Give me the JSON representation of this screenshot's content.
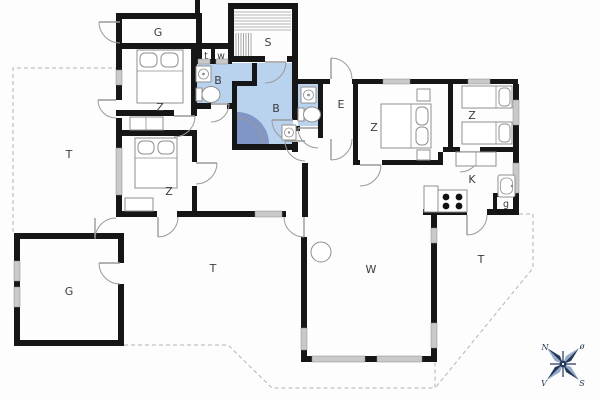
{
  "plan": {
    "rooms": {
      "storage_top": "G",
      "bedroom_1": "Z",
      "bedroom_2": "Z",
      "toilet_closet": "t",
      "wash_closet": "w",
      "sauna": "S",
      "bath_small": "B",
      "bath_large": "B",
      "entrance": "E",
      "bedroom_3": "Z",
      "bedroom_4": "Z",
      "kitchen": "K",
      "pantry": "g",
      "living_room": "W",
      "garage": "G",
      "terrace_left": "T",
      "terrace_middle": "T",
      "terrace_right": "T"
    },
    "compass": {
      "north": "N",
      "east": "ø",
      "south": "S",
      "west": "V"
    },
    "colors": {
      "bath": "#b9d2ee",
      "shower": "#8096c6",
      "wall": "#161616",
      "window": "#c9c9c9",
      "furniture": "#8f8f8f",
      "dash": "#b4b4b4",
      "label": "#3c3c3c",
      "compass": "#24395c",
      "compass_light": "#93aac8"
    }
  }
}
